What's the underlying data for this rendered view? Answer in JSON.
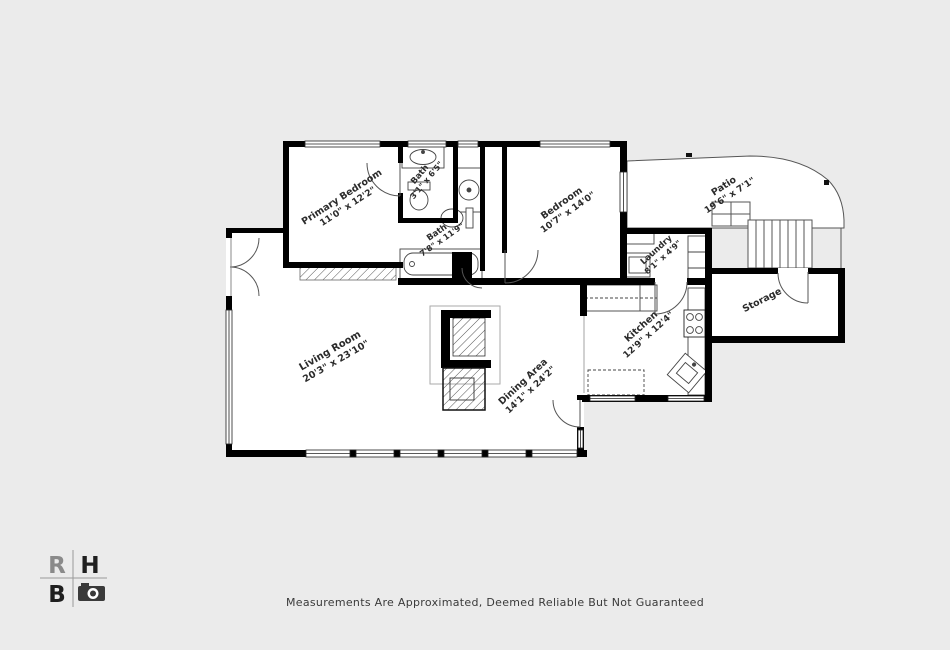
{
  "page": {
    "background_color": "#ebebeb",
    "wall_color": "#000000",
    "floor_color": "#ffffff",
    "label_color": "#2b2b2b",
    "disclaimer": "Measurements Are Approximated, Deemed Reliable But Not Guaranteed"
  },
  "logo": {
    "r": "R",
    "h": "H",
    "b": "B",
    "camera_icon": "camera-icon"
  },
  "rooms": {
    "primary_bedroom": {
      "name": "Primary Bedroom",
      "dims": "11'0\" x 12'2\""
    },
    "bath_small": {
      "name": "Bath",
      "dims": "3'1\" x 6'5\""
    },
    "bath_large": {
      "name": "Bath",
      "dims": "7'8\" x 11'9\""
    },
    "bedroom": {
      "name": "Bedroom",
      "dims": "10'7\" x 14'0\""
    },
    "patio": {
      "name": "Patio",
      "dims": "19'6\" x 7'1\""
    },
    "laundry": {
      "name": "Laundry",
      "dims": "8'1\" x 4'9\""
    },
    "kitchen": {
      "name": "Kitchen",
      "dims": "12'9\" x 12'4\""
    },
    "storage": {
      "name": "Storage",
      "dims": ""
    },
    "living_room": {
      "name": "Living Room",
      "dims": "20'3\" x 23'10\""
    },
    "dining_area": {
      "name": "Dining Area",
      "dims": "14'1\" x 24'2\""
    }
  }
}
